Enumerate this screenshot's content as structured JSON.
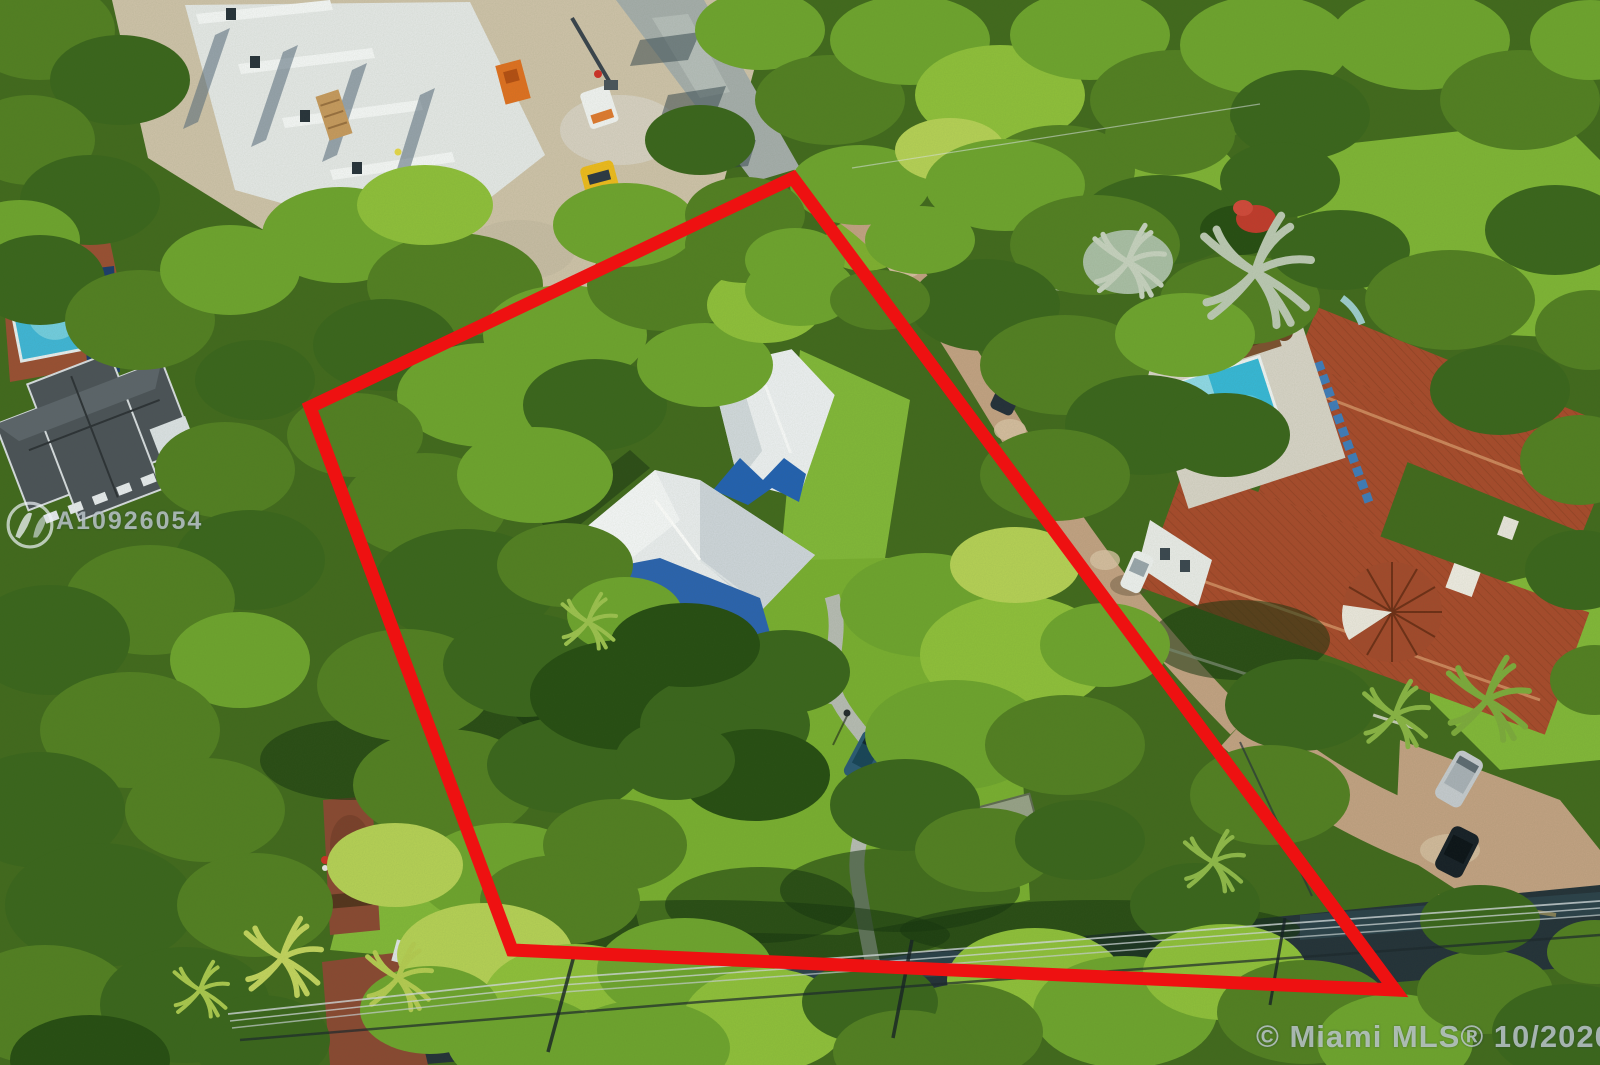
{
  "image": {
    "kind": "aerial drone photo of a residential lot with boundary overlay",
    "width_px": 1600,
    "height_px": 1065
  },
  "watermarks": {
    "listing_id": "A10926054",
    "copyright": "© Miami MLS® 10/2020",
    "text_color": "rgba(198,207,214,0.78)"
  },
  "boundary": {
    "label": "lot-outline",
    "color": "#ee1111",
    "stroke_width": 13,
    "points": "793,178 310,407 512,950 1395,990"
  },
  "palette": {
    "canopy_bright": "#8fc03a",
    "canopy_dark": "#264d12",
    "lawn": "#82b838",
    "pool_water": "#3fb6d8",
    "terracotta_roof": "#a84a2c",
    "white_roof": "#eef1f3",
    "roof_blue_accent": "#2261b2",
    "asphalt_road": "#233139",
    "paver_drive": "#c3a283",
    "construction_concrete": "#e6e9e8",
    "dirt": "#cfc3aa"
  }
}
